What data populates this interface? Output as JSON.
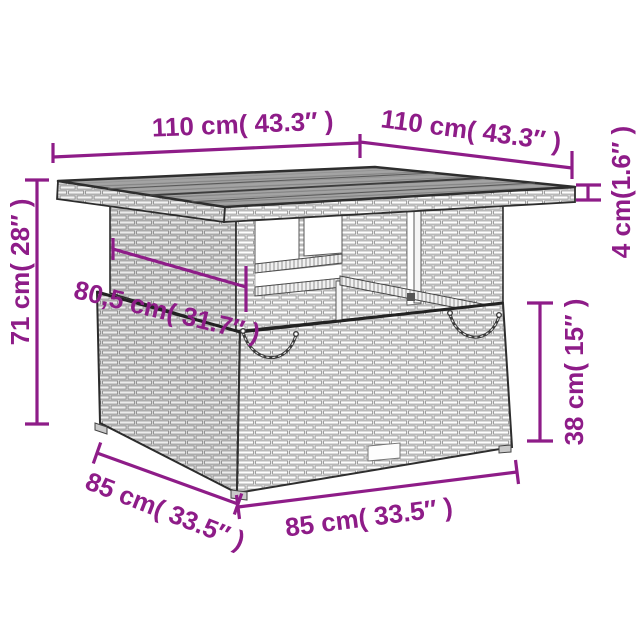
{
  "page": {
    "type": "product-dimension-diagram",
    "background": "#ffffff",
    "subject": "poly rattan garden table line illustration"
  },
  "colors": {
    "dimension_accent": "#8e1c88",
    "drawing_outline": "#2e2e2e",
    "rattan_weave": "#ededed",
    "tabletop_surface": "#a3a3a3"
  },
  "dimensions": {
    "top_width_left": {
      "label": "110 cm( 43.3″ )"
    },
    "top_depth_right": {
      "label": "110 cm( 43.3″ )"
    },
    "overall_height": {
      "label": "71 cm( 28″ )"
    },
    "tabletop_thickness": {
      "label": "4 cm(1.6″ )"
    },
    "tabletop_inner_width": {
      "label": "80,5 cm( 31.7″ )"
    },
    "base_height": {
      "label": "38 cm( 15″ )"
    },
    "base_depth": {
      "label": "85 cm( 33.5″ )"
    },
    "base_width": {
      "label": "85 cm( 33.5″ )"
    }
  }
}
